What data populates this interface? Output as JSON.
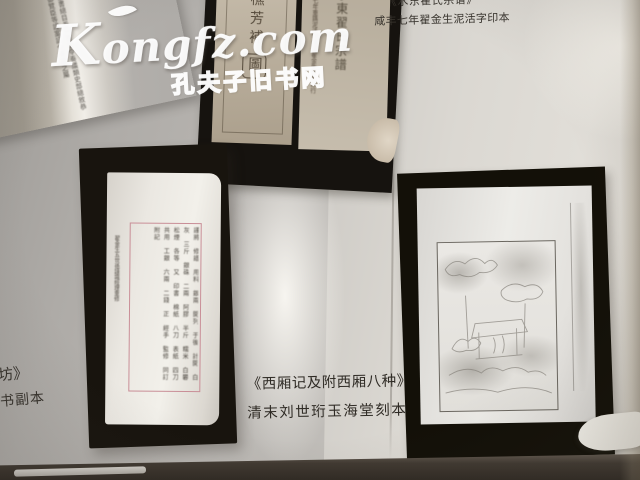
{
  "watermark": {
    "logo": "Kongfz.com",
    "site_name": "孔夫子旧书网"
  },
  "captions": {
    "top_right": {
      "line1": "《水东翟氏宗谱》",
      "line2": "咸丰七年翟金生泥活字印本"
    },
    "right_photo": {
      "line1": "《西厢记及附西厢八种》",
      "line2": "清末刘世珩玉海堂刻本"
    },
    "bottom_left": {
      "line1": "坊》",
      "line2": "书副本"
    }
  },
  "photos": {
    "top_left_book": {
      "blurred_text": "欽定四庫全書總目卷一百詔令奏議類史部總敘恭校上進呈御覽臣等謹案詔令奏議之屬"
    },
    "top_center_book": {
      "seal_title_main": "樵芳補",
      "seal_title_boxed": "圖",
      "right_header": "翟氏藏板",
      "right_title": "水東翟氏宗譜",
      "right_side_text": "咸豐七年重鐫泥活字排印翟金生製版印行"
    },
    "manuscript": {
      "outer_column": "翟金生五世孫謹識經理重修",
      "blurred_text": "謹將 修譜 用料 銀兩 開列 于後 計開 白灰 三斤 銀硃 二兩 阿膠 半斤 糯米 白礬 松煙 各等 又 印書 棉紙 八刀 表紙 四刀 共用 工銀 六兩 二錢 正 經手 監修 同訂 附記"
    }
  },
  "colors": {
    "page_left": "#b1aeaa",
    "page_right": "#dcd9d3",
    "photo_frame": "#17140f",
    "caption_text": "#332f29",
    "manuscript_frame_red": "#c98e97",
    "watermark_white": "#ffffff"
  }
}
